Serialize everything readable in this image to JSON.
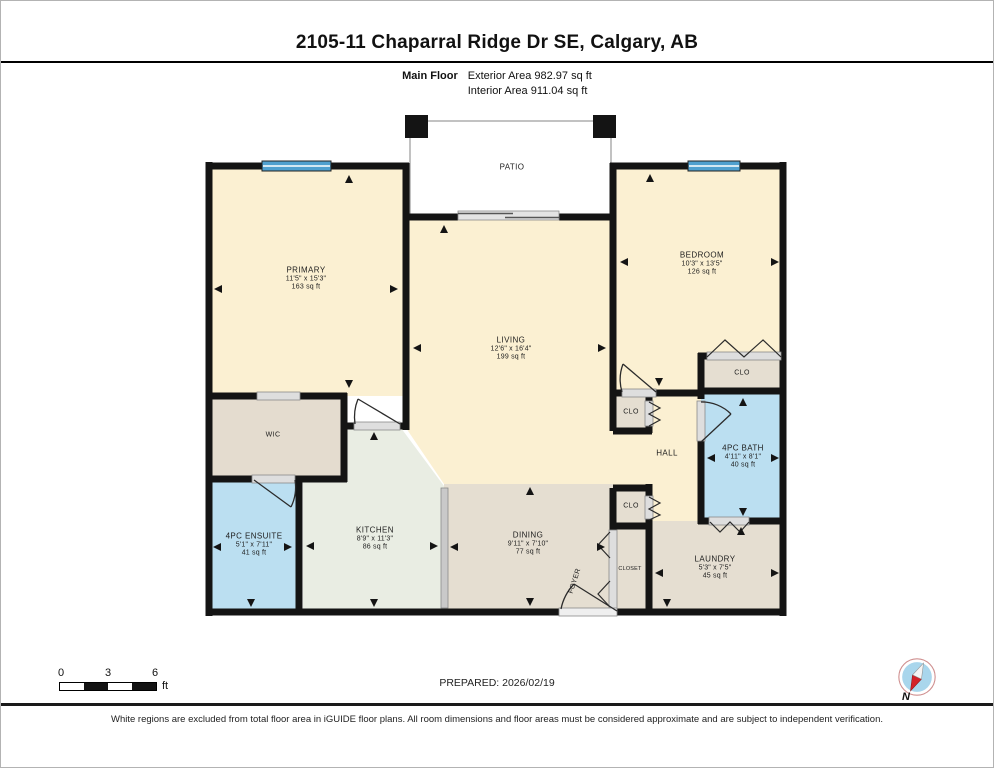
{
  "header": {
    "title": "2105-11 Chaparral Ridge Dr SE, Calgary, AB",
    "floor_label": "Main Floor",
    "exterior_area": "Exterior Area 982.97 sq ft",
    "interior_area": "Interior Area 911.04 sq ft"
  },
  "rooms": {
    "primary": {
      "name": "PRIMARY",
      "dims": "11'5\" x 15'3\"",
      "area": "163 sq ft"
    },
    "living": {
      "name": "LIVING",
      "dims": "12'6\" x 16'4\"",
      "area": "199 sq ft"
    },
    "bedroom": {
      "name": "BEDROOM",
      "dims": "10'3\" x 13'5\"",
      "area": "126 sq ft"
    },
    "patio": {
      "name": "PATIO"
    },
    "wic": {
      "name": "WIC"
    },
    "ensuite": {
      "name": "4PC ENSUITE",
      "dims": "5'1\" x 7'11\"",
      "area": "41 sq ft"
    },
    "kitchen": {
      "name": "KITCHEN",
      "dims": "8'9\" x 11'3\"",
      "area": "86 sq ft"
    },
    "dining": {
      "name": "DINING",
      "dims": "9'11\" x 7'10\"",
      "area": "77 sq ft"
    },
    "hall": {
      "name": "HALL"
    },
    "bath": {
      "name": "4PC BATH",
      "dims": "4'11\" x 8'1\"",
      "area": "40 sq ft"
    },
    "laundry": {
      "name": "LAUNDRY",
      "dims": "5'3\" x 7'5\"",
      "area": "45 sq ft"
    },
    "foyer": {
      "name": "FOYER"
    },
    "closet": {
      "name": "CLOSET"
    },
    "clo": {
      "name": "CLO"
    }
  },
  "footer": {
    "scale": {
      "tick0": "0",
      "tick1": "3",
      "tick2": "6",
      "unit": "ft"
    },
    "prepared": "PREPARED: 2026/02/19",
    "compass_label": "N",
    "disclaimer": "White regions are excluded from total floor area in iGUIDE floor plans. All room dimensions and floor areas must be considered approximate and are subject to independent verification."
  },
  "colors": {
    "room_cream": "#FBF0D2",
    "room_beige": "#E5DED1",
    "room_blue": "#BBDFF1",
    "room_kitchen": "#E9EDE3",
    "window_blue": "#4FA0CF",
    "wall_black": "#141414",
    "compass_red": "#D42127",
    "compass_blue": "#A9D6EC"
  }
}
